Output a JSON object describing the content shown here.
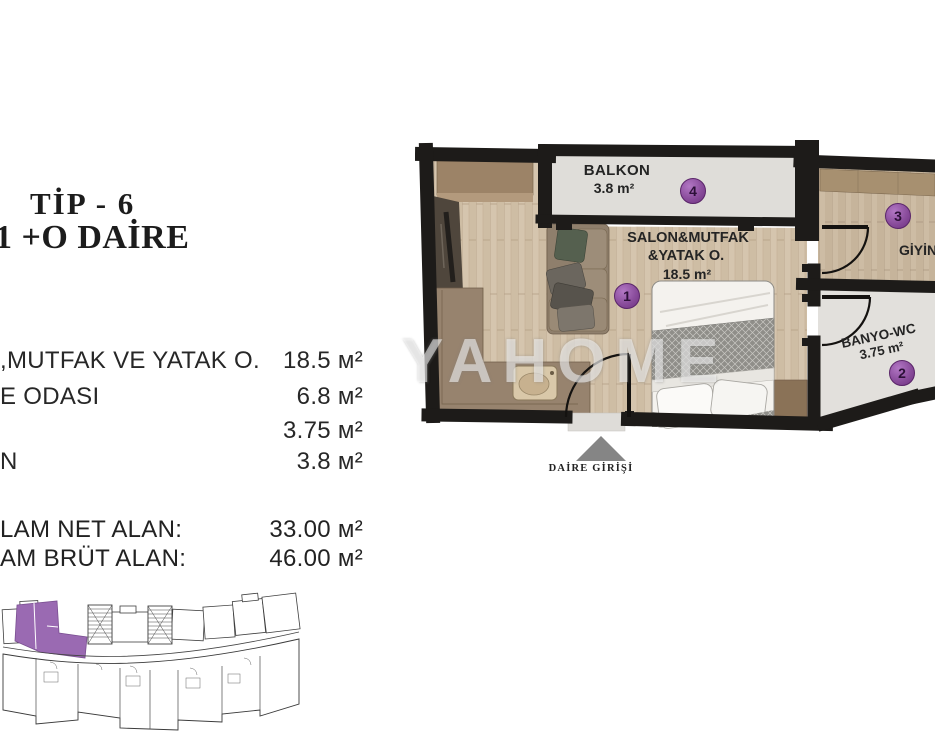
{
  "colors": {
    "accent_purple_circle": "#8a4d9c",
    "mini_plan_highlight": "#9a6ab2",
    "wall_black": "#1d1b19",
    "wood_floor": "#d3c3ac",
    "tile_floor": "#dedcd8",
    "entry_arrow_gray": "#858585"
  },
  "left_panel": {
    "title_line1": "TİP - 6",
    "title_line2": "1 +O DAİRE",
    "rooms": [
      {
        "label": ",MUTFAK VE YATAK O.",
        "area": "18.5 м²"
      },
      {
        "label": "E ODASI",
        "area": "6.8 м²"
      },
      {
        "label": "",
        "area": "3.75 м²"
      },
      {
        "label": "N",
        "area": "3.8 м²"
      }
    ],
    "totals": [
      {
        "label": "LAM NET ALAN:",
        "value": "33.00 м²"
      },
      {
        "label": "AM BRÜT ALAN:",
        "value": "46.00 м²"
      }
    ]
  },
  "plan": {
    "balcony": {
      "name": "BALKON",
      "area": "3.8 m²",
      "number": "4"
    },
    "salon": {
      "name_line1": "SALON&MUTFAK",
      "name_line2": "&YATAK O.",
      "area": "18.5 m²",
      "number": "1"
    },
    "dressing": {
      "name": "GİYİNM",
      "number": "3"
    },
    "bath": {
      "name": "BANYO-WC",
      "area": "3.75 m²",
      "number": "2"
    },
    "entrance_label": "DAİRE GİRİŞİ"
  },
  "watermark": "YAHOME"
}
